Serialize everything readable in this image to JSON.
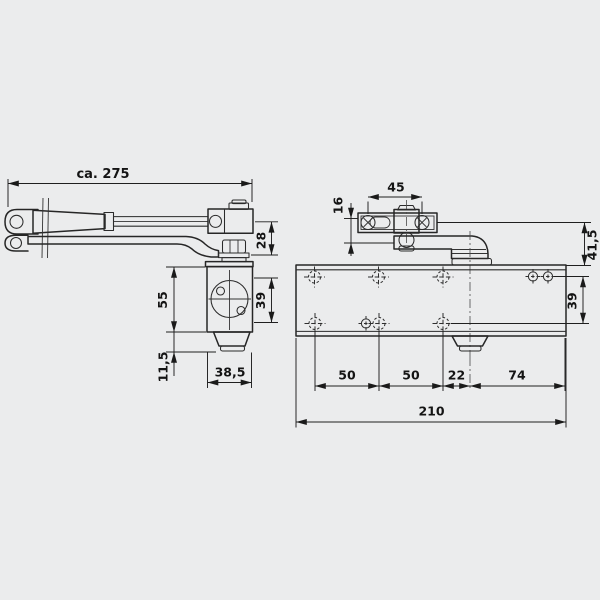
{
  "colors": {
    "background": "#ebeced",
    "line": "#262626",
    "dimension": "#1f1f1f"
  },
  "side_view": {
    "dims": {
      "total_length": "ca. 275",
      "arm_height": "28",
      "body_height": "55",
      "hole_spacing": "39",
      "pinion_depth": "11,5",
      "body_width": "38,5"
    }
  },
  "front_view": {
    "dims": {
      "bracket_hole_spacing": "45",
      "bracket_plate_height": "16",
      "arm_drop": "41,5",
      "hole_row_spacing": "39",
      "hole_pitch_left": "50",
      "hole_pitch_mid": "50",
      "pinion_to_hole": "22",
      "pinion_to_end": "74",
      "body_length": "210"
    }
  }
}
